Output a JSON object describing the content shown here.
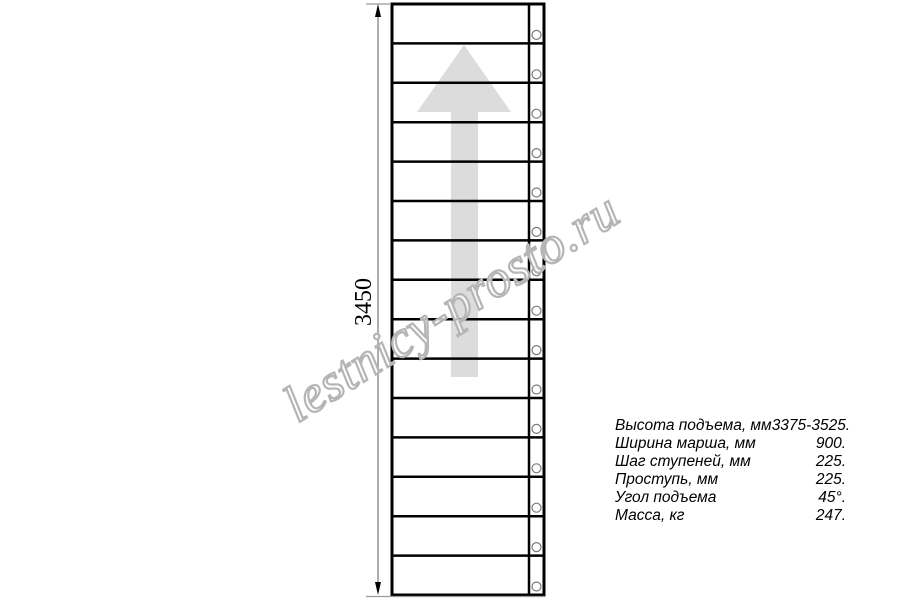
{
  "watermark": {
    "text": "lestnicy-prosto.ru"
  },
  "dimension": {
    "total_height_label": "3450"
  },
  "specs": {
    "rows": [
      {
        "label": "Высота подъема, мм",
        "value": "3375-3525."
      },
      {
        "label": "Ширина марша, мм",
        "value": "900."
      },
      {
        "label": "Шаг ступеней, мм",
        "value": "225."
      },
      {
        "label": "Проступь, мм",
        "value": "225."
      },
      {
        "label": "Угол подъема",
        "value": "45°."
      },
      {
        "label": "Масса, кг",
        "value": "247."
      }
    ]
  },
  "drawing": {
    "tread_count": 15,
    "colors": {
      "line": "#000000",
      "arrow_fill": "#dcdcdc",
      "dimension_line": "#8c8c8c",
      "watermark_outline": "#b5b5b5"
    }
  }
}
